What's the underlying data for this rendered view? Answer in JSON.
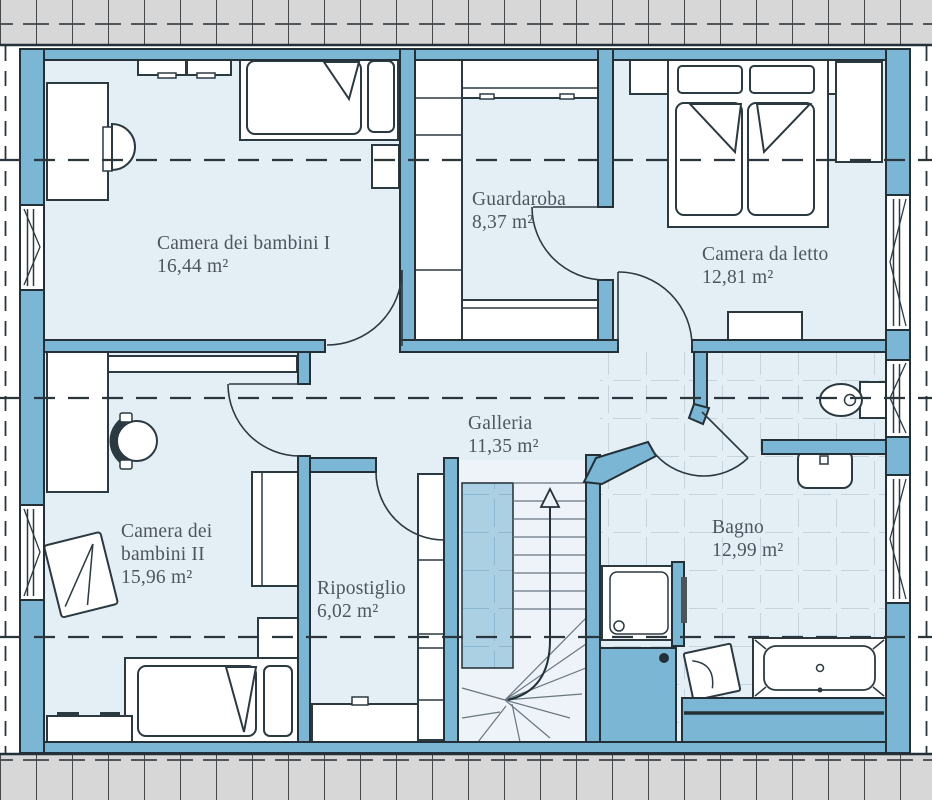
{
  "plan": {
    "type": "floor-plan",
    "unit": "m²",
    "rooms": [
      {
        "id": "camera-bambini-1",
        "name": "Camera dei bambini I",
        "area": "16,44 m²"
      },
      {
        "id": "guardaroba",
        "name": "Guardaroba",
        "area": "8,37 m²"
      },
      {
        "id": "camera-da-letto",
        "name": "Camera da letto",
        "area": "12,81 m²"
      },
      {
        "id": "galleria",
        "name": "Galleria",
        "area": "11,35 m²"
      },
      {
        "id": "camera-bambini-2",
        "name": "Camera dei bambini II",
        "area": "15,96 m²"
      },
      {
        "id": "ripostiglio",
        "name": "Ripostiglio",
        "area": "6,02 m²"
      },
      {
        "id": "bagno",
        "name": "Bagno",
        "area": "12,99 m²"
      }
    ],
    "palette": {
      "wall_blue": "#7bb6d4",
      "floor_light": "#e4eef5",
      "stair_void": "#abcfe3",
      "bath_tile_line": "#c3d4df",
      "roof_tile_gray": "#d7d7d7",
      "outline_dark": "#243038",
      "label_text": "#4d565e"
    }
  }
}
